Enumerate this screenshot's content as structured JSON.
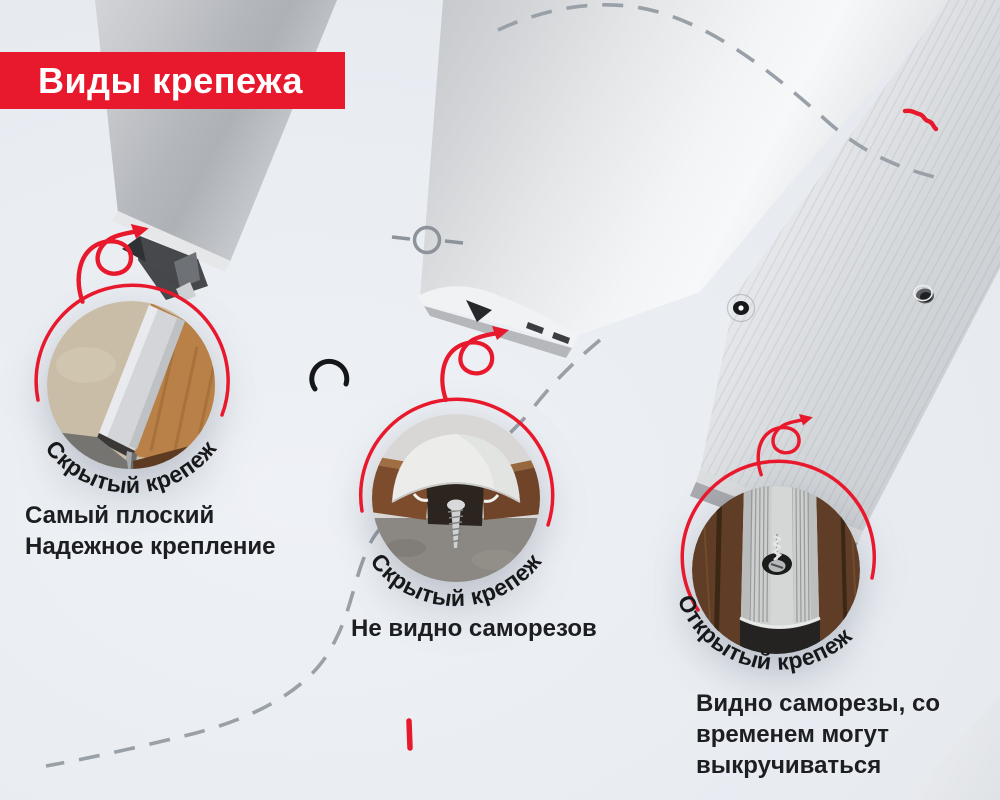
{
  "colors": {
    "background": "#e9edf2",
    "accent_red": "#e8192c",
    "text_dark": "#1d1e21",
    "dash_gray": "#99a0a7",
    "label_dark": "#17181a"
  },
  "banner": {
    "label": "Виды крепежа"
  },
  "fasteners": [
    {
      "photo_icon": "t-profile-between-tile-and-laminate",
      "label": "Скрытый крепеж",
      "caption_lines": [
        "Самый плоский",
        "Надежное крепление"
      ]
    },
    {
      "photo_icon": "dome-profile-hiding-screw",
      "label": "Скрытый крепеж",
      "caption_lines": [
        "Не видно саморезов"
      ]
    },
    {
      "photo_icon": "flat-ribbed-profile-visible-screw",
      "label": "Открытый крепеж",
      "caption_lines": [
        "Видно саморезы, со",
        "временем могут",
        "выкручиваться"
      ]
    }
  ]
}
